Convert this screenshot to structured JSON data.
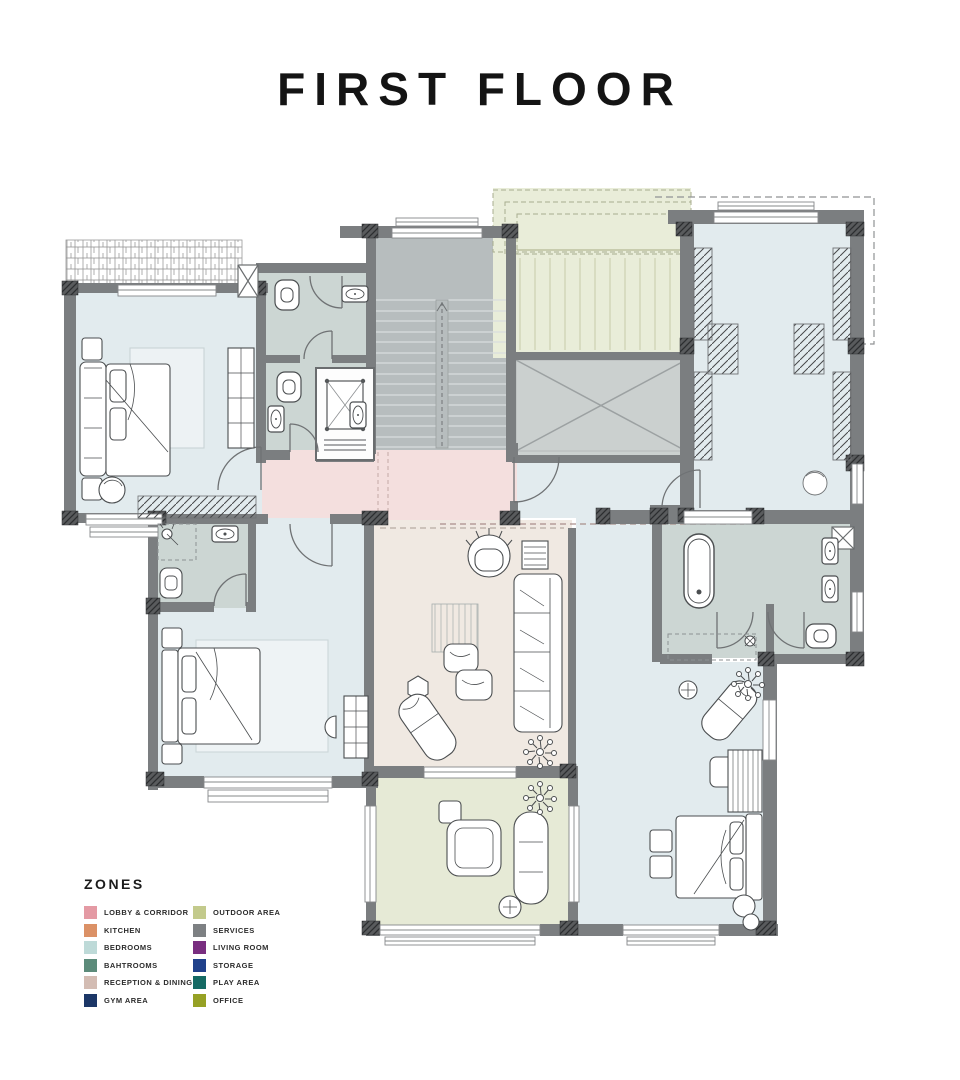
{
  "page": {
    "title": "FIRST FLOOR"
  },
  "legend": {
    "heading": "ZONES",
    "columns": [
      [
        {
          "label": "LOBBY & CORRIDOR",
          "color": "#e49aa4"
        },
        {
          "label": "KITCHEN",
          "color": "#db9166"
        },
        {
          "label": "BEDROOMS",
          "color": "#bedad8"
        },
        {
          "label": "BAHTROOMS",
          "color": "#5c8b7a"
        },
        {
          "label": "RECEPTION & DINING",
          "color": "#d3bcb3"
        },
        {
          "label": "GYM AREA",
          "color": "#1c3767"
        }
      ],
      [
        {
          "label": "OUTDOOR AREA",
          "color": "#c3ca8c"
        },
        {
          "label": "SERVICES",
          "color": "#7d8083"
        },
        {
          "label": "LIVING ROOM",
          "color": "#792e80"
        },
        {
          "label": "STORAGE",
          "color": "#20418b"
        },
        {
          "label": "PLAY AREA",
          "color": "#156a64"
        },
        {
          "label": "OFFICE",
          "color": "#96a125"
        }
      ]
    ]
  },
  "plan": {
    "wall_color": "#7b7e80",
    "zones": [
      {
        "name": "bedroom-1",
        "color": "#e2ebee",
        "x": 72,
        "y": 288,
        "w": 190,
        "h": 230
      },
      {
        "name": "wc-block",
        "color": "#ccd6d3",
        "x": 258,
        "y": 268,
        "w": 114,
        "h": 190
      },
      {
        "name": "staircase",
        "color": "#b7bdbe",
        "x": 370,
        "y": 232,
        "w": 142,
        "h": 220
      },
      {
        "name": "outdoor-terrace",
        "color": "#e9edd9",
        "x": 493,
        "y": 188,
        "w": 198,
        "h": 170
      },
      {
        "name": "void-services",
        "color": "#cbd0cf",
        "x": 512,
        "y": 356,
        "w": 178,
        "h": 104
      },
      {
        "name": "dressing-room",
        "color": "#e2ebee",
        "x": 688,
        "y": 224,
        "w": 162,
        "h": 292
      },
      {
        "name": "lobby-corridor",
        "color": "#f4dfde",
        "x": 262,
        "y": 450,
        "w": 255,
        "h": 70
      },
      {
        "name": "suite-corridor",
        "color": "#e2ebee",
        "x": 517,
        "y": 460,
        "w": 335,
        "h": 58
      },
      {
        "name": "bedroom-2",
        "color": "#e2ebee",
        "x": 156,
        "y": 518,
        "w": 216,
        "h": 262
      },
      {
        "name": "bathroom-2",
        "color": "#ccd6d3",
        "x": 156,
        "y": 518,
        "w": 100,
        "h": 90
      },
      {
        "name": "reception-dining",
        "color": "#f0e9e2",
        "x": 372,
        "y": 520,
        "w": 200,
        "h": 250
      },
      {
        "name": "outdoor-lounge",
        "color": "#e6ead6",
        "x": 372,
        "y": 778,
        "w": 200,
        "h": 150
      },
      {
        "name": "master-hall",
        "color": "#e2ebee",
        "x": 576,
        "y": 518,
        "w": 80,
        "h": 144
      },
      {
        "name": "master-bathroom",
        "color": "#ccd6d3",
        "x": 656,
        "y": 518,
        "w": 196,
        "h": 140
      },
      {
        "name": "master-bedroom",
        "color": "#e2ebee",
        "x": 576,
        "y": 662,
        "w": 190,
        "h": 266
      }
    ]
  }
}
